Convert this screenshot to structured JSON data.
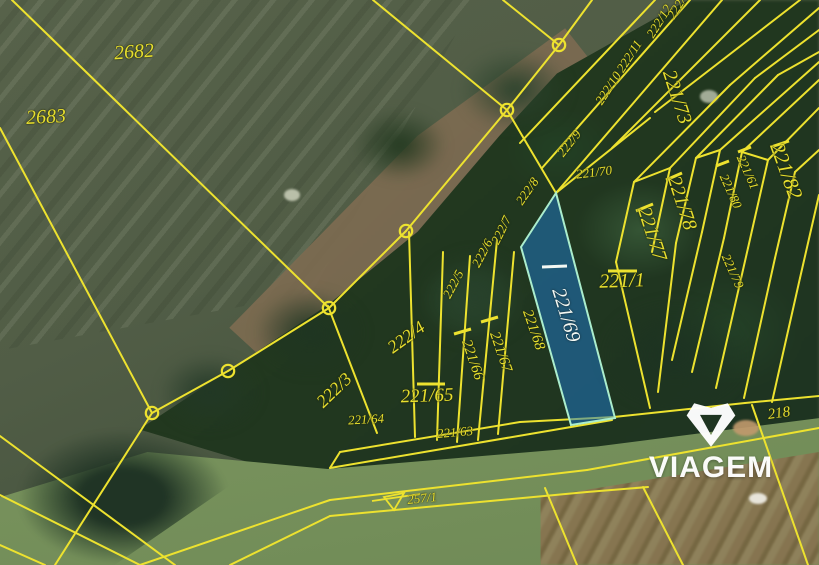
{
  "map": {
    "selected_parcel_id": "221/69",
    "watermark": {
      "brand": "VIAGEM",
      "icon": "viagem-gem-logo"
    },
    "colors": {
      "boundary_yellow": "#ede22f",
      "label_yellow": "#e7df2f",
      "selected_fill": "#1e78c8",
      "selected_fill_opacity": 0.52,
      "selected_stroke": "#abedcd",
      "selected_label_white": "#f4f8f3",
      "watermark_white": "#ffffff"
    },
    "parcel_labels": [
      {
        "text": "2682",
        "x": 134,
        "y": 52,
        "rot": -4,
        "size": 20
      },
      {
        "text": "2683",
        "x": 46,
        "y": 117,
        "rot": -3,
        "size": 20
      },
      {
        "text": "222/3",
        "x": 334,
        "y": 390,
        "rot": -44,
        "size": 18
      },
      {
        "text": "222/4",
        "x": 406,
        "y": 337,
        "rot": -36,
        "size": 18
      },
      {
        "text": "221/64",
        "x": 366,
        "y": 419,
        "rot": -3,
        "size": 13
      },
      {
        "text": "221/65",
        "x": 427,
        "y": 396,
        "rot": -2,
        "size": 19
      },
      {
        "text": "221/63",
        "x": 455,
        "y": 432,
        "rot": -5,
        "size": 13
      },
      {
        "text": "222/5",
        "x": 453,
        "y": 284,
        "rot": -62,
        "size": 13
      },
      {
        "text": "222/6",
        "x": 482,
        "y": 253,
        "rot": -62,
        "size": 13
      },
      {
        "text": "222/7",
        "x": 501,
        "y": 230,
        "rot": -64,
        "size": 13
      },
      {
        "text": "222/8",
        "x": 527,
        "y": 191,
        "rot": -55,
        "size": 13
      },
      {
        "text": "222/9",
        "x": 569,
        "y": 143,
        "rot": -52,
        "size": 13
      },
      {
        "text": "222/10",
        "x": 608,
        "y": 88,
        "rot": -57,
        "size": 13
      },
      {
        "text": "222/11",
        "x": 629,
        "y": 56,
        "rot": -57,
        "size": 13
      },
      {
        "text": "222/12",
        "x": 659,
        "y": 21,
        "rot": -58,
        "size": 13
      },
      {
        "text": "222/1",
        "x": 678,
        "y": 5,
        "rot": -58,
        "size": 13
      },
      {
        "text": "221/70",
        "x": 594,
        "y": 172,
        "rot": -7,
        "size": 13
      },
      {
        "text": "221/73",
        "x": 677,
        "y": 97,
        "rot": 72,
        "size": 20
      },
      {
        "text": "221/78",
        "x": 682,
        "y": 203,
        "rot": 72,
        "size": 20
      },
      {
        "text": "221/77",
        "x": 652,
        "y": 234,
        "rot": 72,
        "size": 20
      },
      {
        "text": "221/79",
        "x": 733,
        "y": 271,
        "rot": 66,
        "size": 13
      },
      {
        "text": "221/80",
        "x": 731,
        "y": 191,
        "rot": 66,
        "size": 13
      },
      {
        "text": "221/61",
        "x": 748,
        "y": 172,
        "rot": 66,
        "size": 13
      },
      {
        "text": "221/82",
        "x": 786,
        "y": 171,
        "rot": 70,
        "size": 21
      },
      {
        "text": "221/1",
        "x": 622,
        "y": 281,
        "rot": -2,
        "size": 20
      },
      {
        "text": "221/66",
        "x": 472,
        "y": 360,
        "rot": 71,
        "size": 15
      },
      {
        "text": "221/67",
        "x": 500,
        "y": 352,
        "rot": 71,
        "size": 15
      },
      {
        "text": "221/68",
        "x": 533,
        "y": 330,
        "rot": 71,
        "size": 15
      },
      {
        "text": "221/69",
        "x": 566,
        "y": 315,
        "rot": 73,
        "size": 20,
        "color": "white"
      },
      {
        "text": "218",
        "x": 779,
        "y": 414,
        "rot": -8,
        "size": 15
      },
      {
        "text": "257/1",
        "x": 422,
        "y": 498,
        "rot": -6,
        "size": 13
      }
    ],
    "vertex_circles": [
      [
        559,
        45
      ],
      [
        507,
        110
      ],
      [
        406,
        231
      ],
      [
        329,
        308
      ],
      [
        228,
        371
      ],
      [
        152,
        413
      ]
    ],
    "selected_parcel": {
      "id": "221/69",
      "polygon": [
        [
          556,
          193
        ],
        [
          521,
          247
        ],
        [
          571,
          425
        ],
        [
          615,
          418
        ]
      ]
    },
    "tick_marks": [
      {
        "x1": 542,
        "y1": 267,
        "x2": 567,
        "y2": 266,
        "color": "white",
        "meaning": "selected-parcel-tick"
      },
      {
        "x1": 417,
        "y1": 384,
        "x2": 445,
        "y2": 384,
        "meaning": "overline-221-65"
      },
      {
        "x1": 608,
        "y1": 271,
        "x2": 637,
        "y2": 271,
        "meaning": "overline-221-1"
      },
      {
        "x1": 666,
        "y1": 180,
        "x2": 682,
        "y2": 173,
        "meaning": "tick-221-78"
      },
      {
        "x1": 636,
        "y1": 211,
        "x2": 653,
        "y2": 204,
        "meaning": "tick-221-77"
      },
      {
        "x1": 771,
        "y1": 147,
        "x2": 789,
        "y2": 141,
        "meaning": "tick-221-82"
      },
      {
        "x1": 738,
        "y1": 152,
        "x2": 751,
        "y2": 147,
        "meaning": "tick-221-61"
      },
      {
        "x1": 716,
        "y1": 166,
        "x2": 729,
        "y2": 161,
        "meaning": "tick-221-80"
      },
      {
        "x1": 454,
        "y1": 334,
        "x2": 471,
        "y2": 329,
        "meaning": "end-tick-221-66"
      },
      {
        "x1": 481,
        "y1": 322,
        "x2": 498,
        "y2": 317,
        "meaning": "end-tick-221-67"
      }
    ],
    "road_symbol": {
      "parcel": "257/1",
      "triangle": [
        [
          384,
          497
        ],
        [
          404,
          493
        ],
        [
          394,
          510
        ]
      ],
      "line": [
        372,
        501,
        420,
        494
      ]
    },
    "boundary_segments": [
      [
        12,
        0,
        329,
        308
      ],
      [
        0,
        128,
        152,
        413
      ],
      [
        373,
        0,
        507,
        110
      ],
      [
        503,
        0,
        559,
        45
      ],
      [
        592,
        0,
        559,
        45
      ],
      [
        559,
        45,
        507,
        110
      ],
      [
        507,
        110,
        406,
        231
      ],
      [
        406,
        231,
        329,
        308
      ],
      [
        329,
        308,
        228,
        371
      ],
      [
        228,
        371,
        152,
        413
      ],
      [
        152,
        413,
        55,
        565
      ],
      [
        0,
        495,
        140,
        565
      ],
      [
        0,
        436,
        175,
        565
      ],
      [
        0,
        545,
        45,
        565
      ],
      [
        507,
        110,
        556,
        193
      ],
      [
        377,
        433,
        328,
        306
      ],
      [
        415,
        437,
        409,
        232
      ],
      [
        437,
        440,
        443,
        252
      ],
      [
        457,
        442,
        470,
        256
      ],
      [
        478,
        440,
        497,
        240
      ],
      [
        498,
        434,
        514,
        252
      ],
      [
        520,
        143,
        655,
        0
      ],
      [
        542,
        168,
        690,
        0
      ],
      [
        556,
        193,
        722,
        0
      ],
      [
        612,
        148,
        760,
        0
      ],
      [
        655,
        112,
        800,
        0
      ],
      [
        556,
        193,
        650,
        118
      ],
      [
        616,
        262,
        650,
        408
      ],
      [
        616,
        262,
        634,
        182
      ],
      [
        634,
        182,
        730,
        85
      ],
      [
        730,
        85,
        819,
        8
      ],
      [
        652,
        252,
        670,
        168
      ],
      [
        670,
        168,
        755,
        78
      ],
      [
        755,
        78,
        819,
        30
      ],
      [
        676,
        243,
        696,
        158
      ],
      [
        696,
        158,
        778,
        75
      ],
      [
        778,
        75,
        819,
        52
      ],
      [
        676,
        243,
        658,
        392
      ],
      [
        702,
        232,
        720,
        150
      ],
      [
        720,
        150,
        819,
        62
      ],
      [
        702,
        232,
        672,
        360
      ],
      [
        724,
        238,
        742,
        152
      ],
      [
        742,
        152,
        819,
        80
      ],
      [
        724,
        238,
        692,
        372
      ],
      [
        748,
        248,
        768,
        160
      ],
      [
        768,
        160,
        819,
        108
      ],
      [
        748,
        248,
        716,
        388
      ],
      [
        775,
        258,
        795,
        172
      ],
      [
        795,
        172,
        819,
        150
      ],
      [
        775,
        258,
        744,
        398
      ],
      [
        800,
        278,
        819,
        195
      ],
      [
        800,
        278,
        772,
        402
      ],
      [
        634,
        182,
        670,
        168
      ],
      [
        696,
        158,
        720,
        150
      ],
      [
        742,
        152,
        768,
        160
      ],
      [
        340,
        452,
        520,
        422
      ],
      [
        520,
        422,
        614,
        417
      ],
      [
        614,
        417,
        745,
        403
      ],
      [
        745,
        403,
        819,
        396
      ],
      [
        330,
        468,
        530,
        434
      ],
      [
        530,
        434,
        612,
        420
      ],
      [
        340,
        452,
        330,
        468
      ],
      [
        140,
        565,
        330,
        500
      ],
      [
        330,
        500,
        587,
        470
      ],
      [
        587,
        470,
        819,
        428
      ],
      [
        230,
        565,
        330,
        516
      ],
      [
        330,
        516,
        587,
        492
      ],
      [
        587,
        492,
        648,
        487
      ],
      [
        545,
        488,
        577,
        565
      ],
      [
        643,
        487,
        683,
        565
      ],
      [
        752,
        405,
        808,
        565
      ]
    ]
  }
}
